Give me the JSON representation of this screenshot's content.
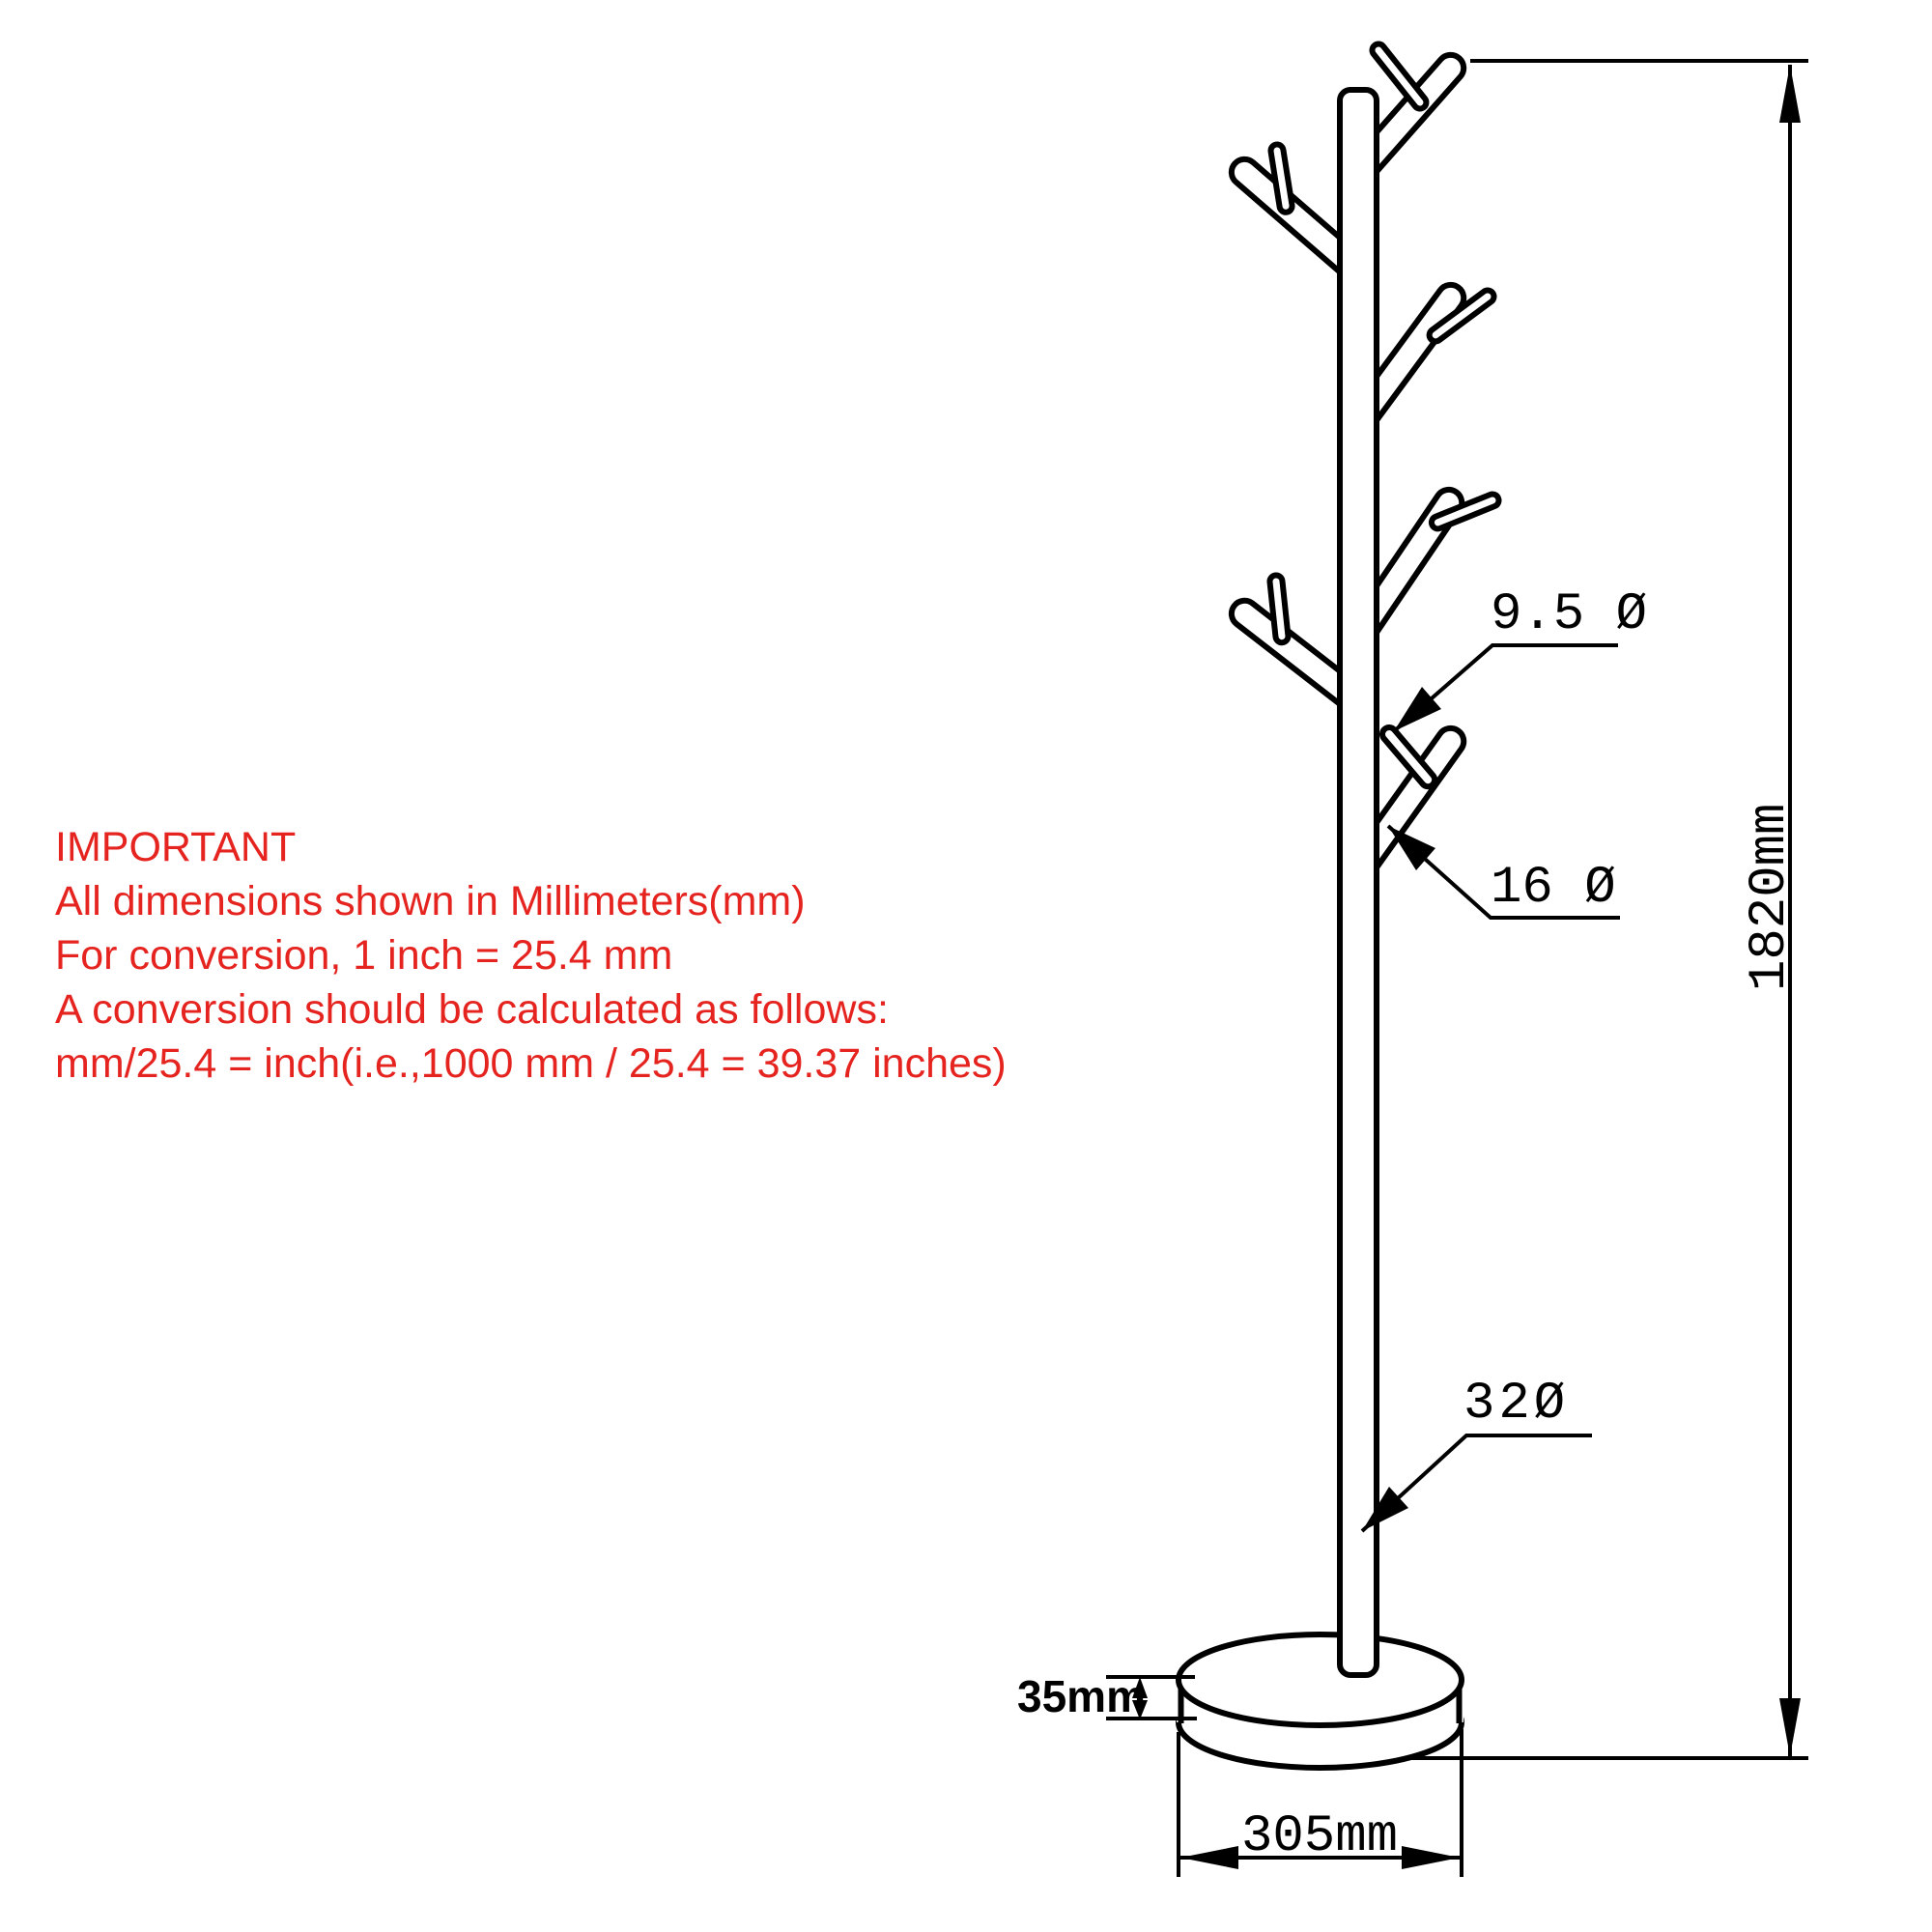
{
  "notice": {
    "title": "IMPORTANT",
    "lines": [
      "All dimensions shown in Millimeters(mm)",
      "For conversion, 1 inch = 25.4 mm",
      "A conversion should be calculated as follows:",
      "mm/25.4 = inch(i.e.,1000 mm / 25.4 = 39.37 inches)"
    ],
    "color": "#e52420"
  },
  "drawing": {
    "title": "coat-rack-technical-drawing",
    "labels": {
      "hook_diameter": "9.5 Ø",
      "peg_diameter": "16 Ø",
      "pole_diameter": "32Ø",
      "overall_height": "1820mm",
      "base_thickness": "35mm",
      "base_diameter": "305mm"
    },
    "line_color": "#000000",
    "background": "#ffffff"
  }
}
